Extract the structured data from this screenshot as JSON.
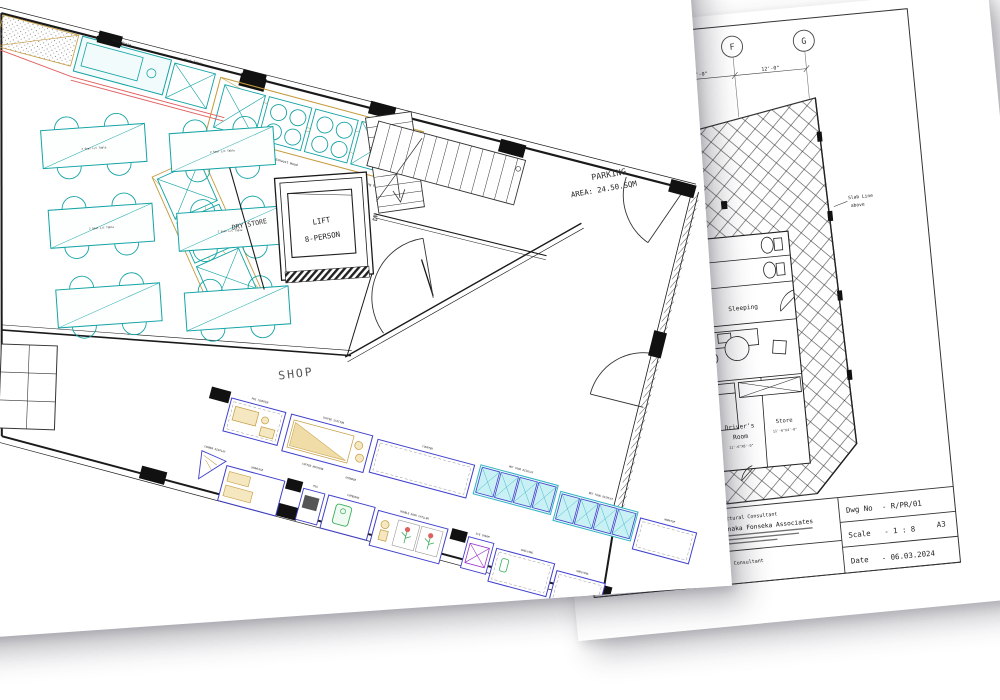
{
  "front_sheet": {
    "room_labels": {
      "shop": "SHOP",
      "parking_1": "PARKING",
      "parking_2": "AREA: 24.50.SQM",
      "lift_1": "LIFT",
      "lift_2": "8-PERSON",
      "dry_store": "DRY STORE",
      "stairs_dn": "DN"
    },
    "table_label": "2 Seat L/C Table",
    "kitchen_labels": [
      "Wash Basin",
      "Work Table",
      "Exhaust Hood",
      "Cooking Range"
    ],
    "shop_row1_labels": [
      "POS COUNTER",
      "COFFEE STATION",
      "COUNTER",
      "HOT FOOD DISPLAY",
      "WET FOOD DISPLAY",
      "WORKTOP"
    ],
    "shop_row1_sublabels": [
      "COFFEE MACHINE",
      "GRINDER"
    ],
    "shop_row2_labels": [
      "CORNER DISPLAY",
      "SHOWCASE",
      "POS",
      "CUPBOARD",
      "DOUBLE DOOR CHILLER",
      "ICE CREAM",
      "SHELVING",
      "SHELVING"
    ]
  },
  "back_sheet": {
    "grid_labels": [
      "D",
      "E",
      "F",
      "G"
    ],
    "dimensions": {
      "ef": "12'-0\"",
      "fg": "12'-0\""
    },
    "notes": {
      "slab_1": "Slab Line",
      "slab_2": "above"
    },
    "rooms": {
      "sleeping": "Sleeping",
      "drivers_1": "Driver's",
      "drivers_2": "Room",
      "drivers_dim": "11'-6\"X8'-0\"",
      "store": "Store",
      "store_dim": "11'-6\"X4'-0\""
    },
    "titleblock": {
      "arch_label": "Architectural Consultant",
      "arch_firm": "Senaka Fonseka Associates",
      "eng_label": "Engineering Consultant",
      "dwg_label": "Dwg No",
      "dwg_value": "- R/PR/01",
      "scale_label": "Scale",
      "scale_value": "- 1 : 8",
      "sheet_size": "A3",
      "date_label": "Date",
      "date_value": "- 06.03.2024"
    }
  },
  "colors": {
    "equipment_teal": "#14A3A5",
    "counter_tan": "#C49A3C",
    "prep_red": "#E06060",
    "fixture_blue": "#4040CC",
    "display_cyan": "#2FB3C3",
    "accent_green": "#3AAE5C",
    "accent_purple": "#9932CC",
    "wall_black": "#1A1A1A"
  }
}
